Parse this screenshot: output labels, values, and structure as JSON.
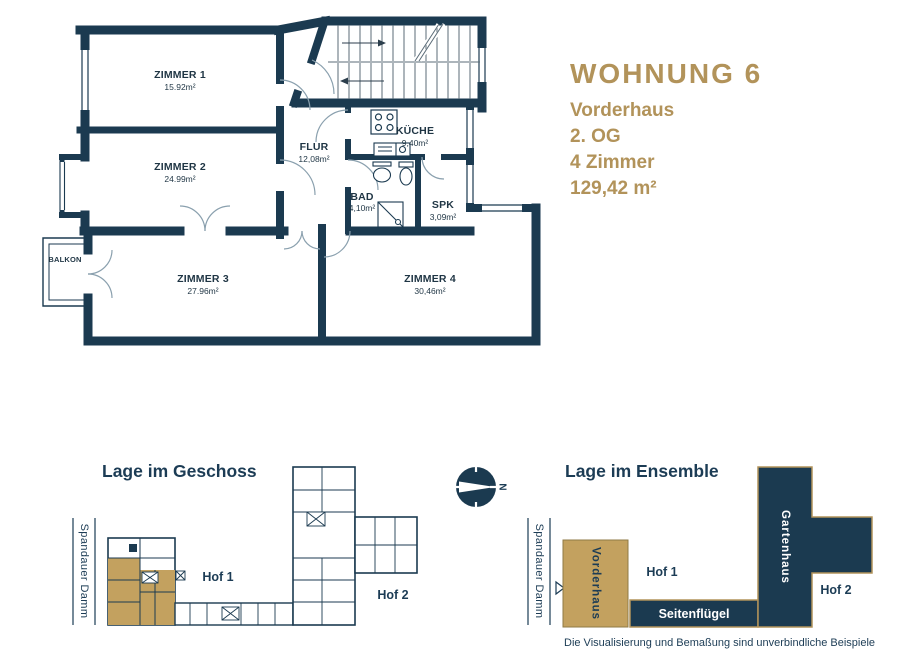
{
  "header": {
    "title": "WOHNUNG 6",
    "building": "Vorderhaus",
    "floor": "2. OG",
    "rooms": "4 Zimmer",
    "area": "129,42 m²"
  },
  "floorplan": {
    "rooms": [
      {
        "name": "ZIMMER 1",
        "area": "15.92m²"
      },
      {
        "name": "ZIMMER 2",
        "area": "24.99m²"
      },
      {
        "name": "ZIMMER 3",
        "area": "27.96m²"
      },
      {
        "name": "ZIMMER 4",
        "area": "30,46m²"
      },
      {
        "name": "FLUR",
        "area": "12,08m²"
      },
      {
        "name": "KÜCHE",
        "area": "9,40m²"
      },
      {
        "name": "BAD",
        "area": "4,10m²"
      },
      {
        "name": "SPK",
        "area": "3,09m²"
      },
      {
        "name": "BALKON",
        "area": ""
      }
    ]
  },
  "compass": {
    "north": "N"
  },
  "geschoss": {
    "title": "Lage im Geschoss",
    "street": "Spandauer Damm",
    "hof1": "Hof 1",
    "hof2": "Hof 2"
  },
  "ensemble": {
    "title": "Lage im Ensemble",
    "street": "Spandauer Damm",
    "vorderhaus": "Vorderhaus",
    "seitenfluegel": "Seitenflügel",
    "gartenhaus": "Gartenhaus",
    "hof1": "Hof 1",
    "hof2": "Hof 2"
  },
  "footer": {
    "disclaimer": "Die Visualisierung und Bemaßung sind unverbindliche Beispiele"
  },
  "colors": {
    "navy": "#1b3a50",
    "gold": "#b2935a",
    "highlight": "#c3a15f"
  }
}
